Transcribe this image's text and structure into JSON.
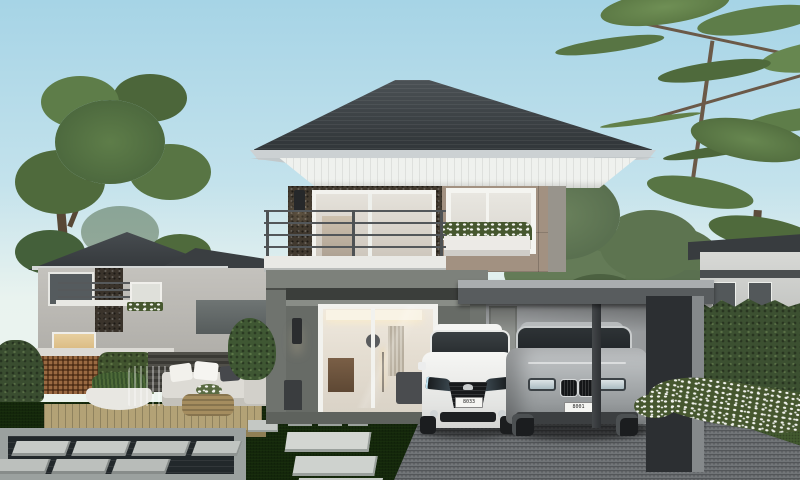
{
  "scene": {
    "type": "architectural-exterior-render",
    "description": "Modern two-story detached house with dark hip roof, stone feature wall, balcony, flat-roof carport with two sedans, garden pond with stepping stones, outdoor lounge set and landscaped lawn; neighbouring houses and trees in background",
    "colors": {
      "sky-top": "#a6d4e6",
      "sky-horizon": "#e9f3ef",
      "roof": "#33383b",
      "fascia": "#eff1ee",
      "stone-wall": "#41392f",
      "taupe-wall": "#a29181",
      "gray-wall": "#6f736e",
      "carport-wall": "#b0b3b5",
      "column": "#2c2f32",
      "driveway": "#55585b",
      "grass": "#4c6a39",
      "deck": "#b3a276",
      "water": "#22282b",
      "paver": "#ccd0cd",
      "hedge": "#3c5031",
      "tree": "#55713f",
      "sofa": "#dddbd5",
      "rattan": "#a58d5f",
      "flowers": "#f2f3ee"
    }
  },
  "cars": [
    {
      "name": "white-sedan-front-view",
      "color": "#f0f1ef",
      "plate": "8033"
    },
    {
      "name": "silver-sedan-front-view",
      "color": "#9fa3a5",
      "plate": "8001"
    }
  ]
}
